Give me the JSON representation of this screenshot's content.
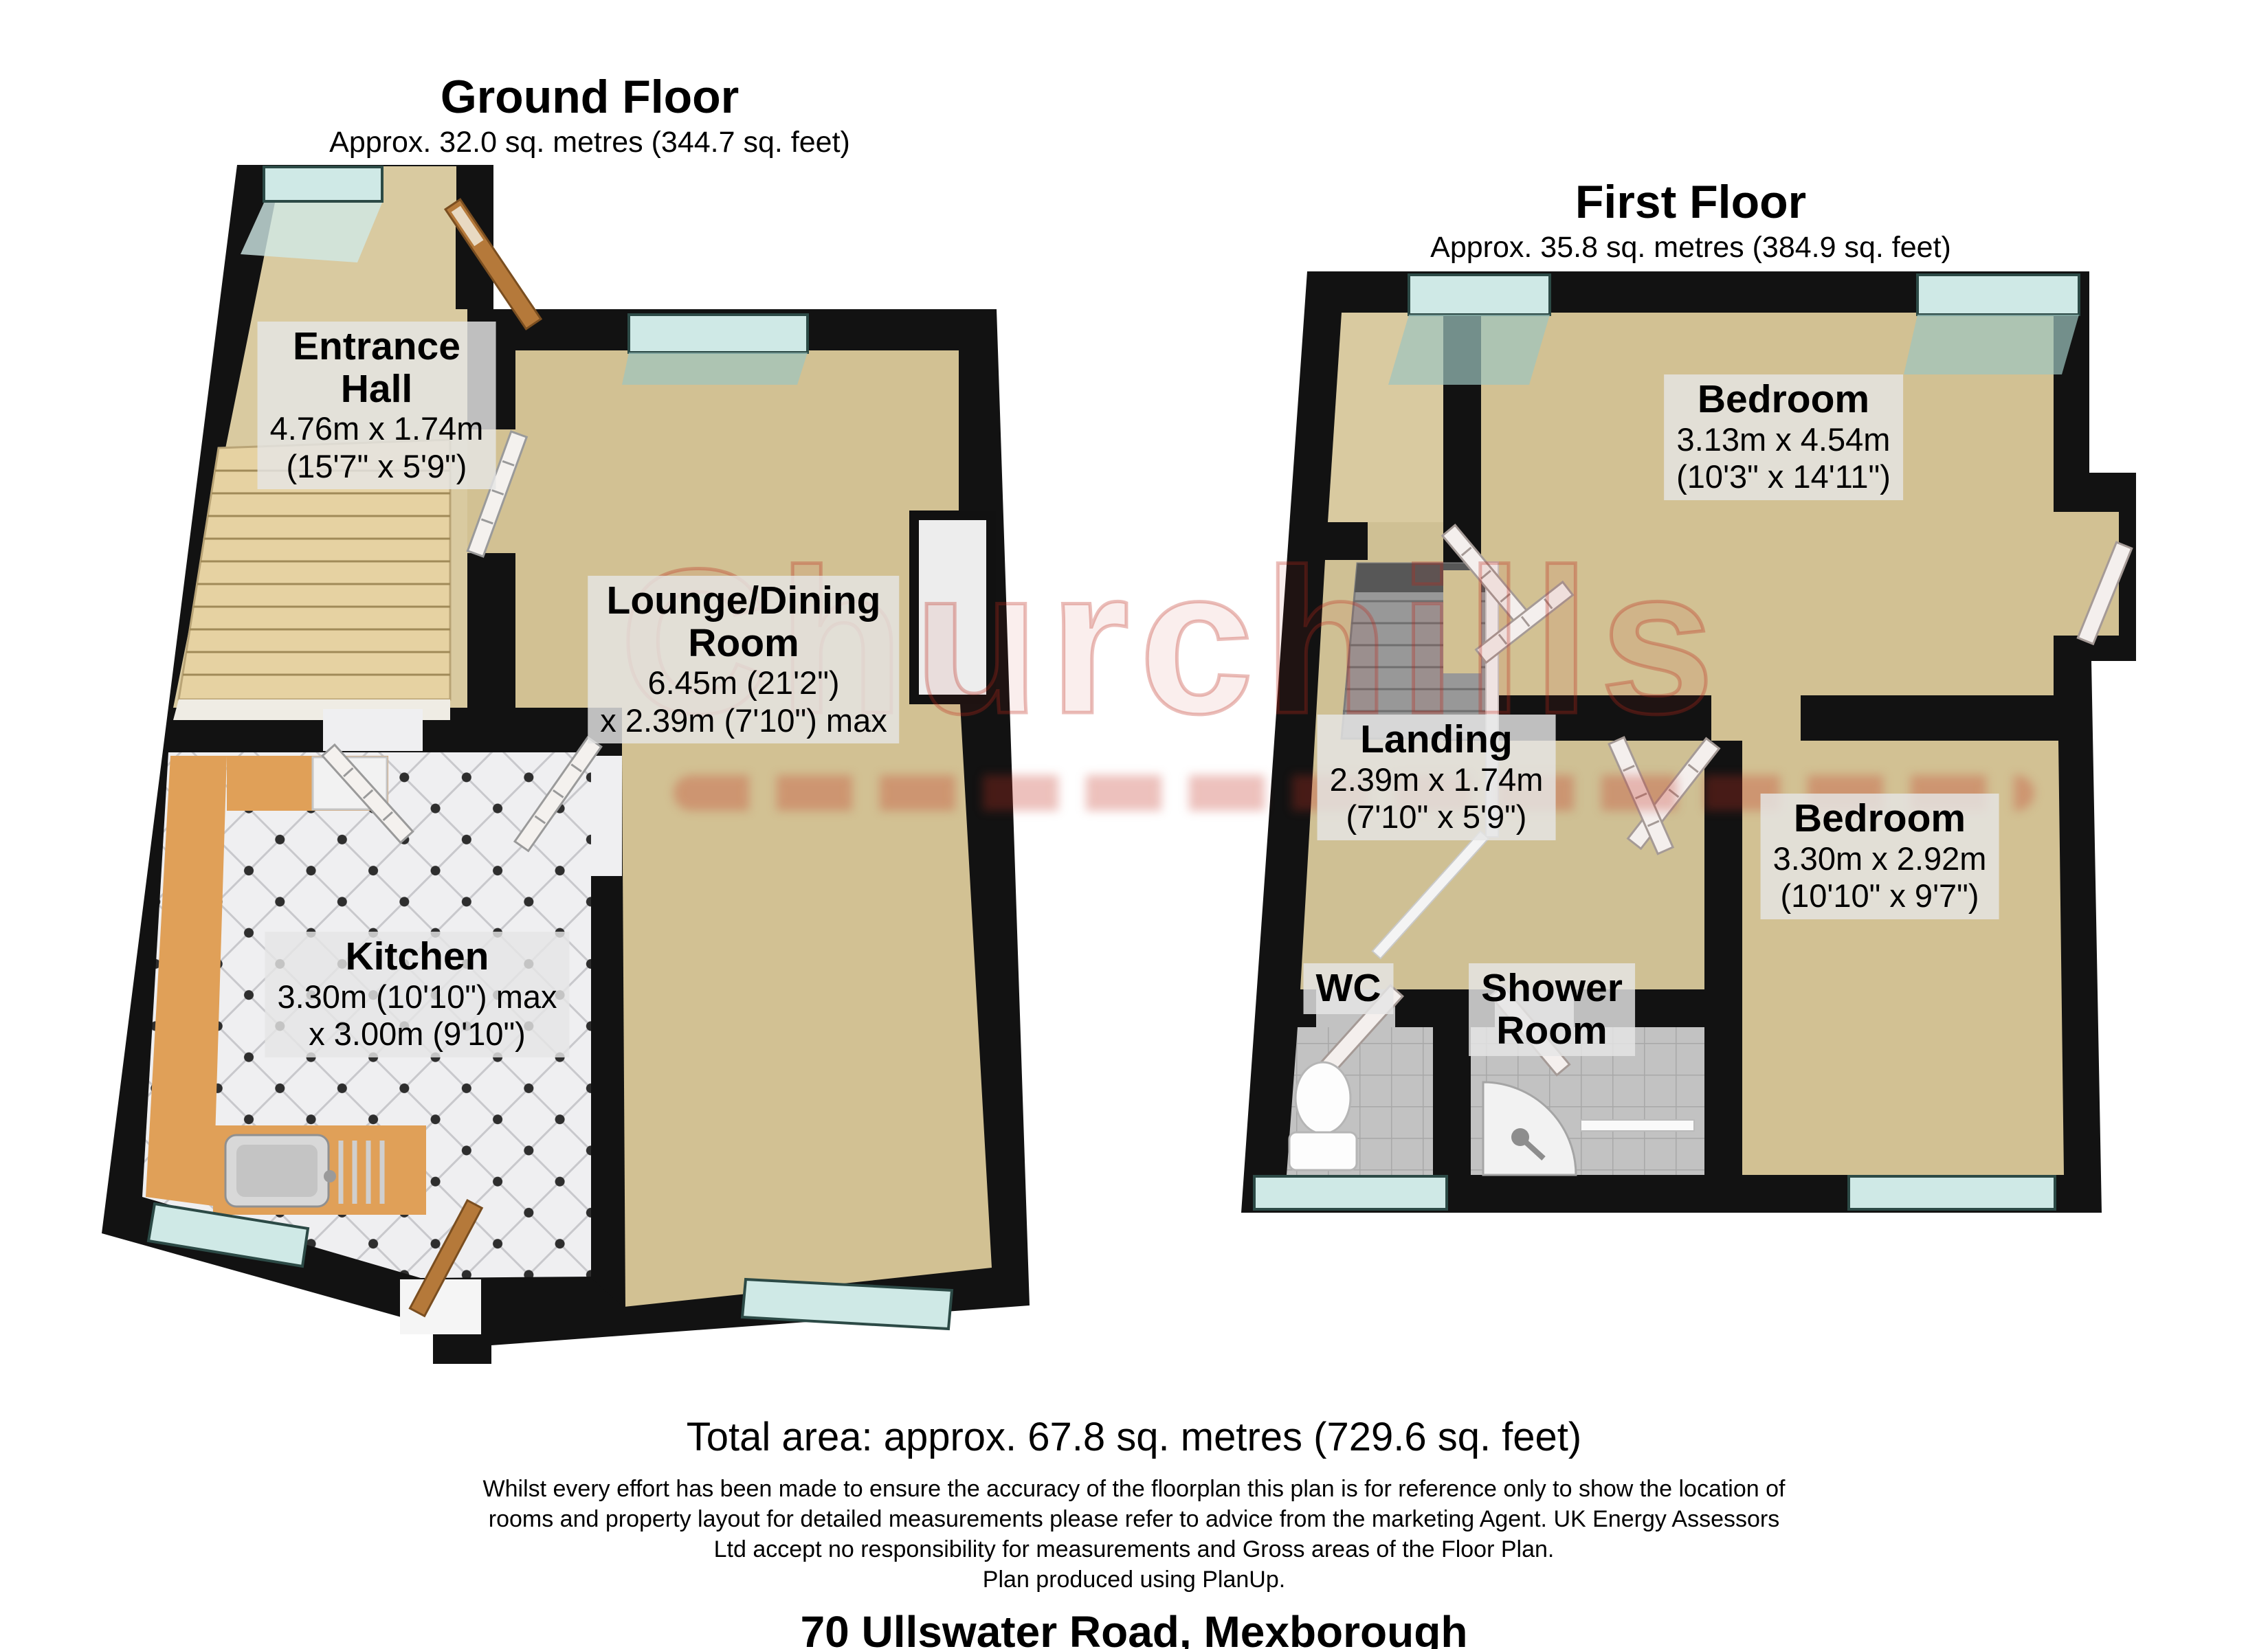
{
  "ground_floor": {
    "title": "Ground Floor",
    "area": "Approx. 32.0 sq. metres (344.7 sq. feet)",
    "rooms": {
      "entrance_hall": {
        "name1": "Entrance",
        "name2": "Hall",
        "dim_metric": "4.76m x 1.74m",
        "dim_imperial": "(15'7\" x 5'9\")"
      },
      "lounge": {
        "name1": "Lounge/Dining",
        "name2": "Room",
        "dim_metric": "6.45m (21'2\")",
        "dim_imperial": "x 2.39m (7'10\") max"
      },
      "kitchen": {
        "name": "Kitchen",
        "dim_metric": "3.30m (10'10\") max",
        "dim_imperial": "x 3.00m (9'10\")"
      }
    }
  },
  "first_floor": {
    "title": "First Floor",
    "area": "Approx. 35.8 sq. metres (384.9 sq. feet)",
    "rooms": {
      "bedroom1": {
        "name": "Bedroom",
        "dim_metric": "3.13m x 4.54m",
        "dim_imperial": "(10'3\" x 14'11\")"
      },
      "landing": {
        "name": "Landing",
        "dim_metric": "2.39m x 1.74m",
        "dim_imperial": "(7'10\" x 5'9\")"
      },
      "bedroom2": {
        "name": "Bedroom",
        "dim_metric": "3.30m x 2.92m",
        "dim_imperial": "(10'10\" x 9'7\")"
      },
      "wc": {
        "name": "WC"
      },
      "shower_room": {
        "name1": "Shower",
        "name2": "Room"
      }
    }
  },
  "footer": {
    "total_area": "Total area: approx. 67.8 sq. metres (729.6 sq. feet)",
    "disclaimer_line1": "Whilst every effort has been made to ensure the accuracy of the floorplan this plan is for reference only to show the location of",
    "disclaimer_line2": "rooms and property layout for detailed measurements please refer to advice from the marketing Agent. UK Energy Assessors",
    "disclaimer_line3": "Ltd accept no responsibility for measurements and Gross areas of the Floor Plan.",
    "disclaimer_line4": "Plan produced using PlanUp.",
    "address": "70 Ullswater Road, Mexborough"
  },
  "watermark": {
    "text": "Churchills"
  },
  "colors": {
    "wall": "#121212",
    "carpet": "#d2c193",
    "hall_floor": "#d9caa0",
    "glass": "#cfe9e6",
    "counter_orange": "#e0a058",
    "tile_gray": "#c2c2c2",
    "watermark_red": "#be281c",
    "label_bg": "#e5e5e5"
  }
}
